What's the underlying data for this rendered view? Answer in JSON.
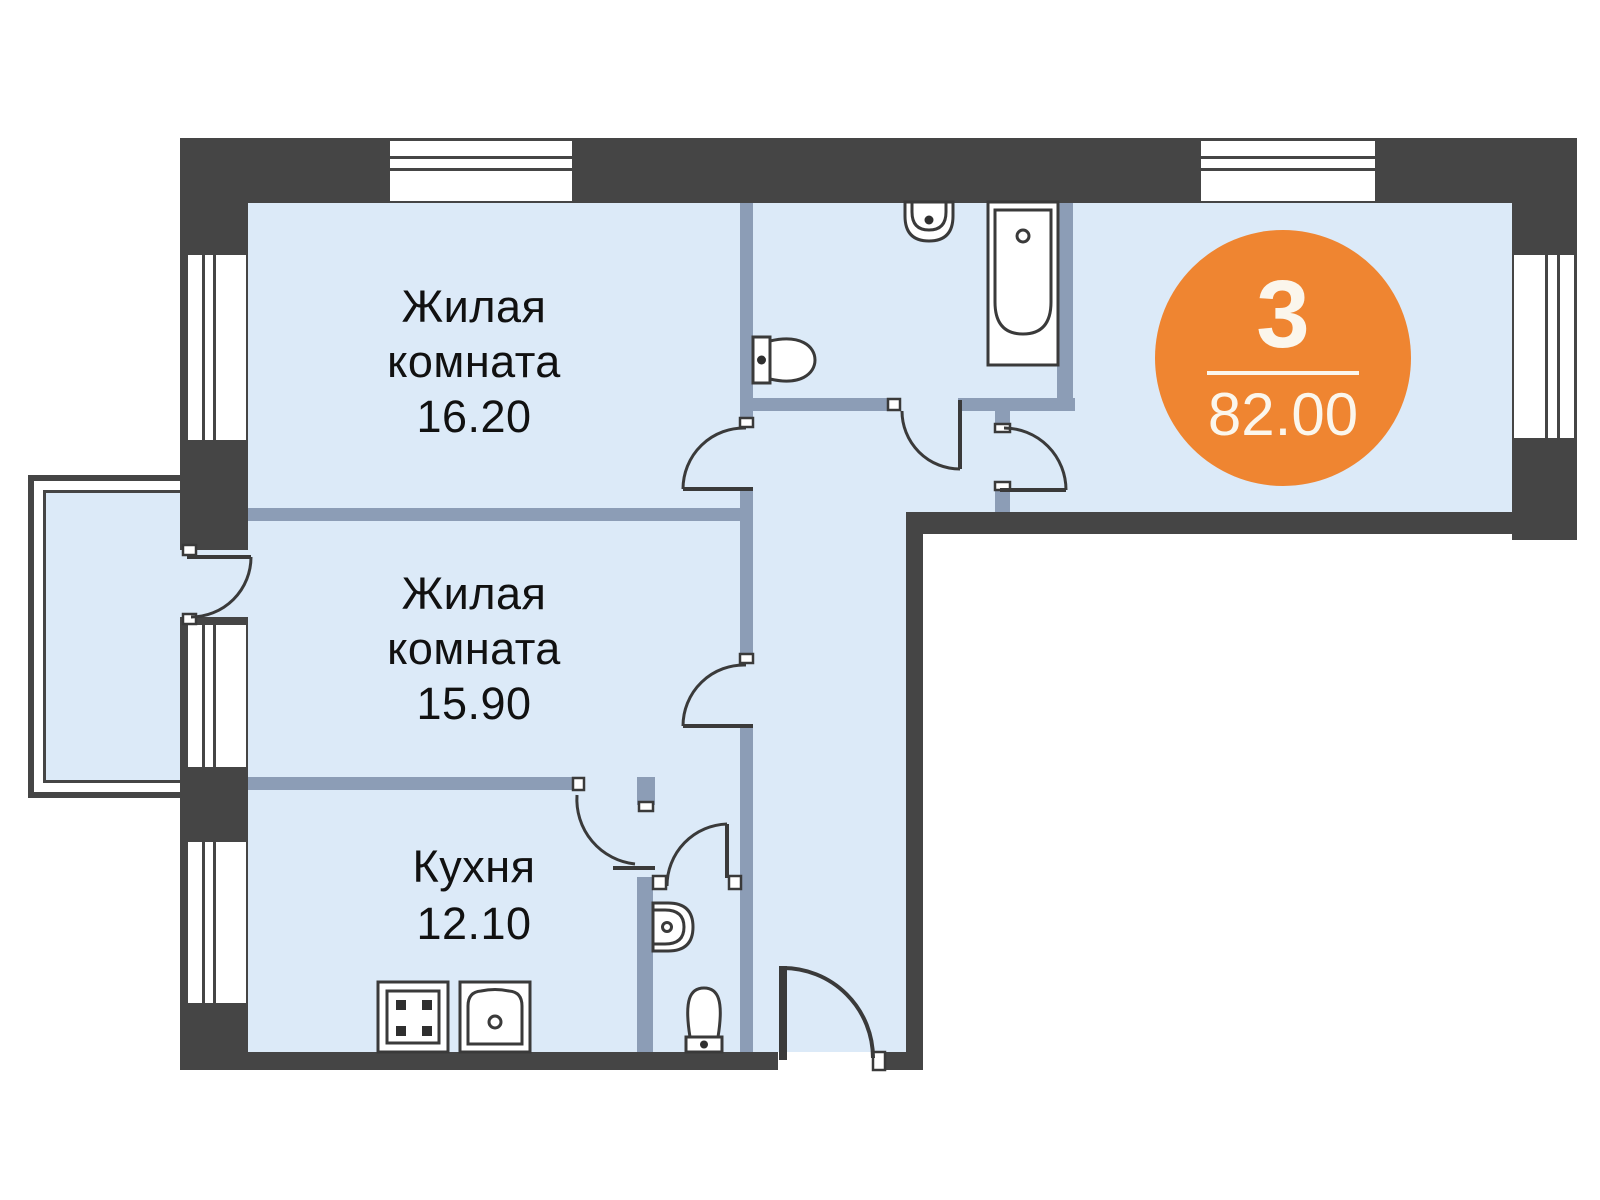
{
  "plan": {
    "badge": {
      "rooms_count": "3",
      "area_total": "82.00"
    },
    "rooms": [
      {
        "id": "living-room-1",
        "line1": "Жилая",
        "line2": "комната",
        "area": "16.20"
      },
      {
        "id": "living-room-2",
        "line1": "Жилая",
        "line2": "комната",
        "area": "15.90"
      },
      {
        "id": "kitchen",
        "line1": "Кухня",
        "area": "12.10"
      }
    ],
    "fixtures": [
      "bathtub",
      "bathroom-sink",
      "toilet",
      "wc-sink",
      "wc-toilet",
      "stove",
      "kitchen-sink",
      "balcony"
    ],
    "colors": {
      "accent_orange": "#EF8531",
      "wall_dark": "#454545",
      "wall_interior": "#8C9DB6",
      "floor": "#DCEAF8",
      "badge_text": "#FBF6EC"
    }
  }
}
